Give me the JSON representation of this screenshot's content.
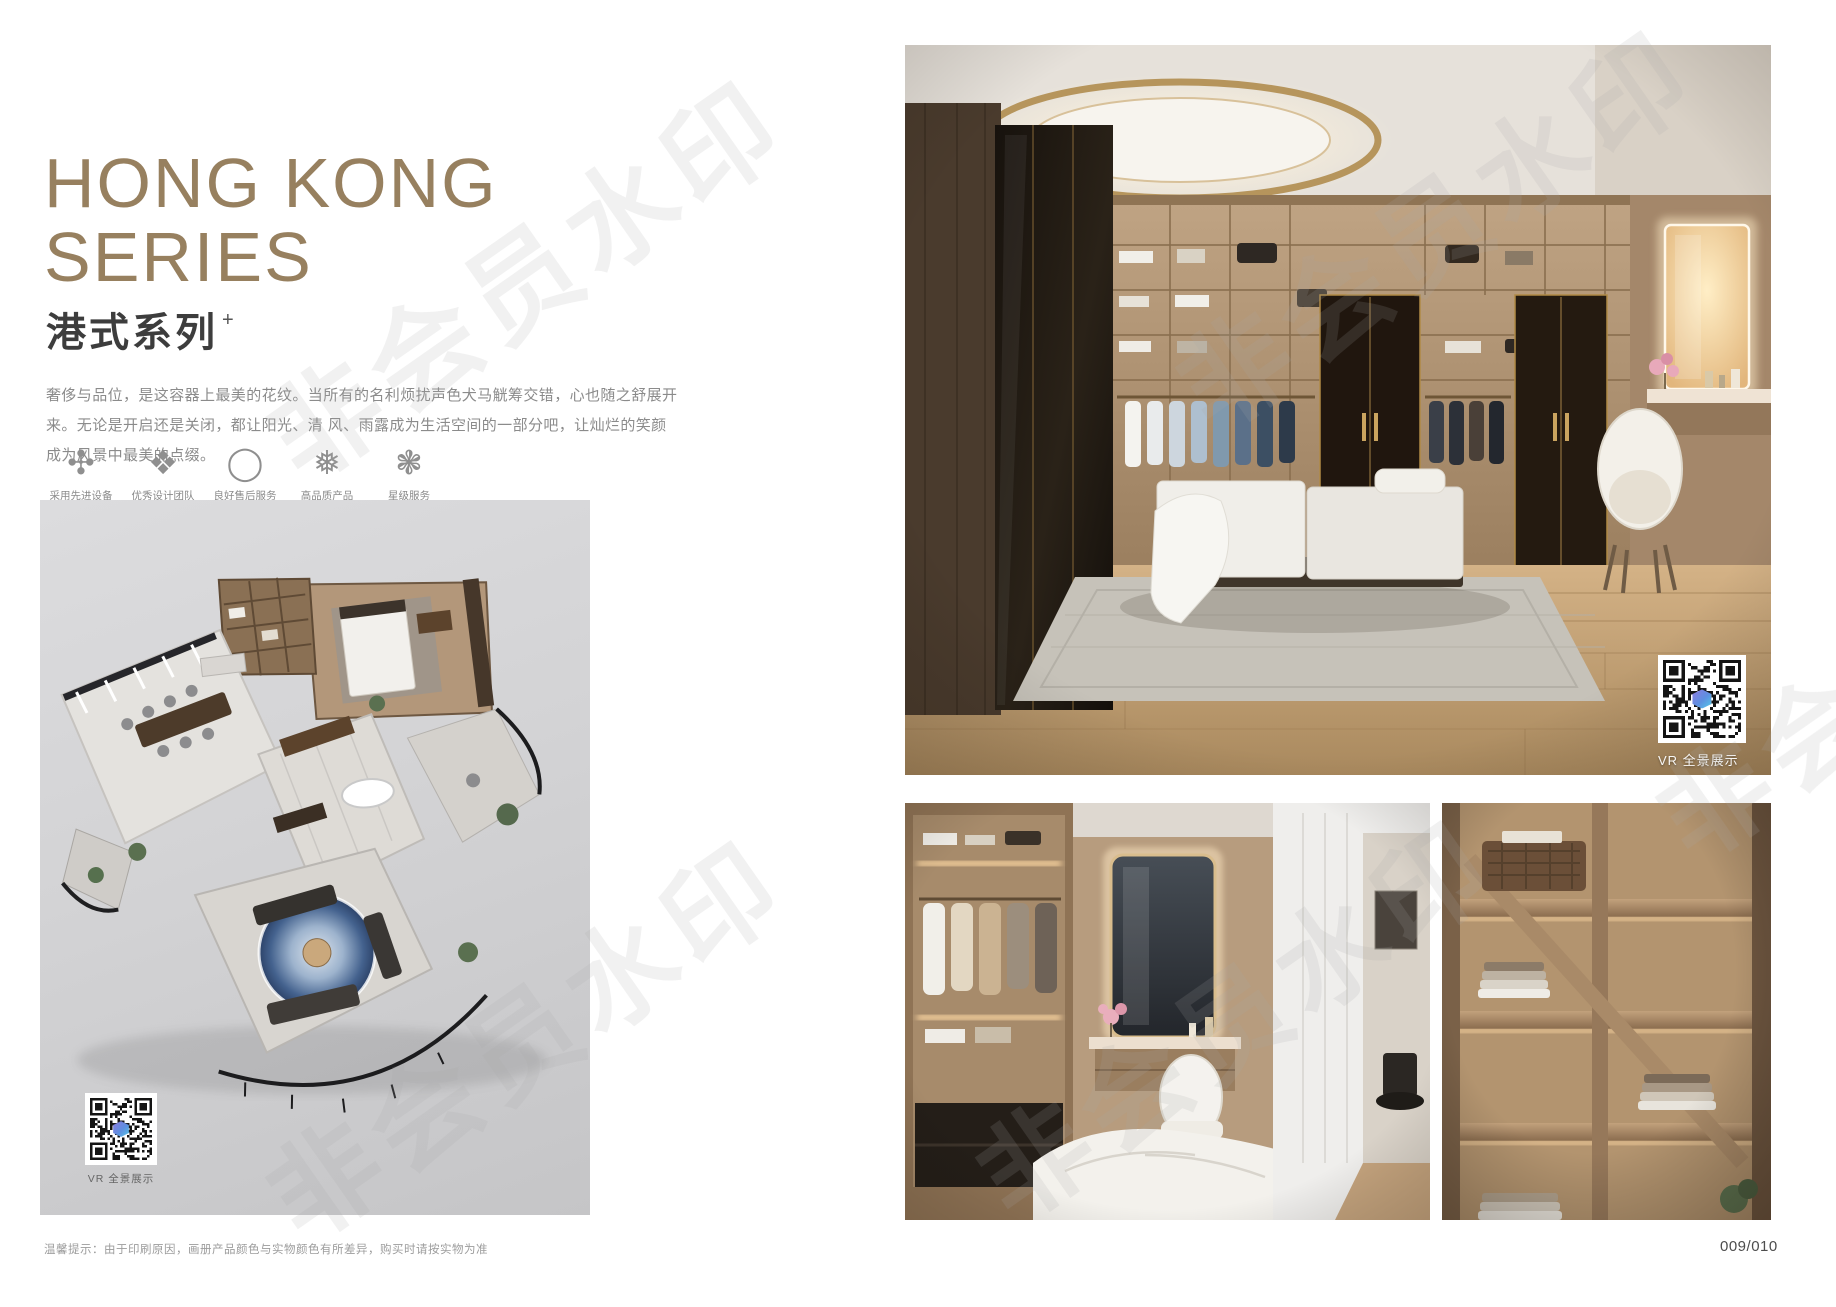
{
  "page": {
    "title_line1": "HONG KONG",
    "title_line2": "SERIES",
    "subtitle": "港式系列",
    "subtitle_mark": "+",
    "description_line1": "奢侈与品位，是这容器上最美的花纹。当所有的名利烦扰声色犬马觥筹交错，心也随之舒展开来。无论是开启还是关闭，都让阳光、清",
    "description_line2": "风、雨露成为生活空间的一部分吧，让灿烂的笑颜成为风景中最美的点缀。",
    "footer_note": "温馨提示：由于印刷原因，画册产品颜色与实物颜色有所差异，购买时请按实物为准",
    "page_number": "009/010",
    "watermark_text": "非会员水印"
  },
  "features": [
    {
      "label": "采用先进设备",
      "glyph": "✣",
      "icon": "pinwheel-icon"
    },
    {
      "label": "优秀设计团队",
      "glyph": "❖",
      "icon": "rosette-icon"
    },
    {
      "label": "良好售后服务",
      "glyph": "◯",
      "icon": "ring-icon"
    },
    {
      "label": "高品质产品",
      "glyph": "❅",
      "icon": "snowflake-icon"
    },
    {
      "label": "星级服务",
      "glyph": "❃",
      "icon": "star-flower-icon"
    }
  ],
  "floorplan": {
    "vr_caption": "VR 全景展示"
  },
  "gallery": {
    "vr_caption": "VR 全景展示"
  },
  "colors": {
    "title_bronze": "#97805f",
    "subtitle_dark": "#3d3d3d",
    "body_text_gray": "#8b8b8b",
    "panel_gray": "#d3d3d5",
    "gold_trim": "#b6955c"
  }
}
